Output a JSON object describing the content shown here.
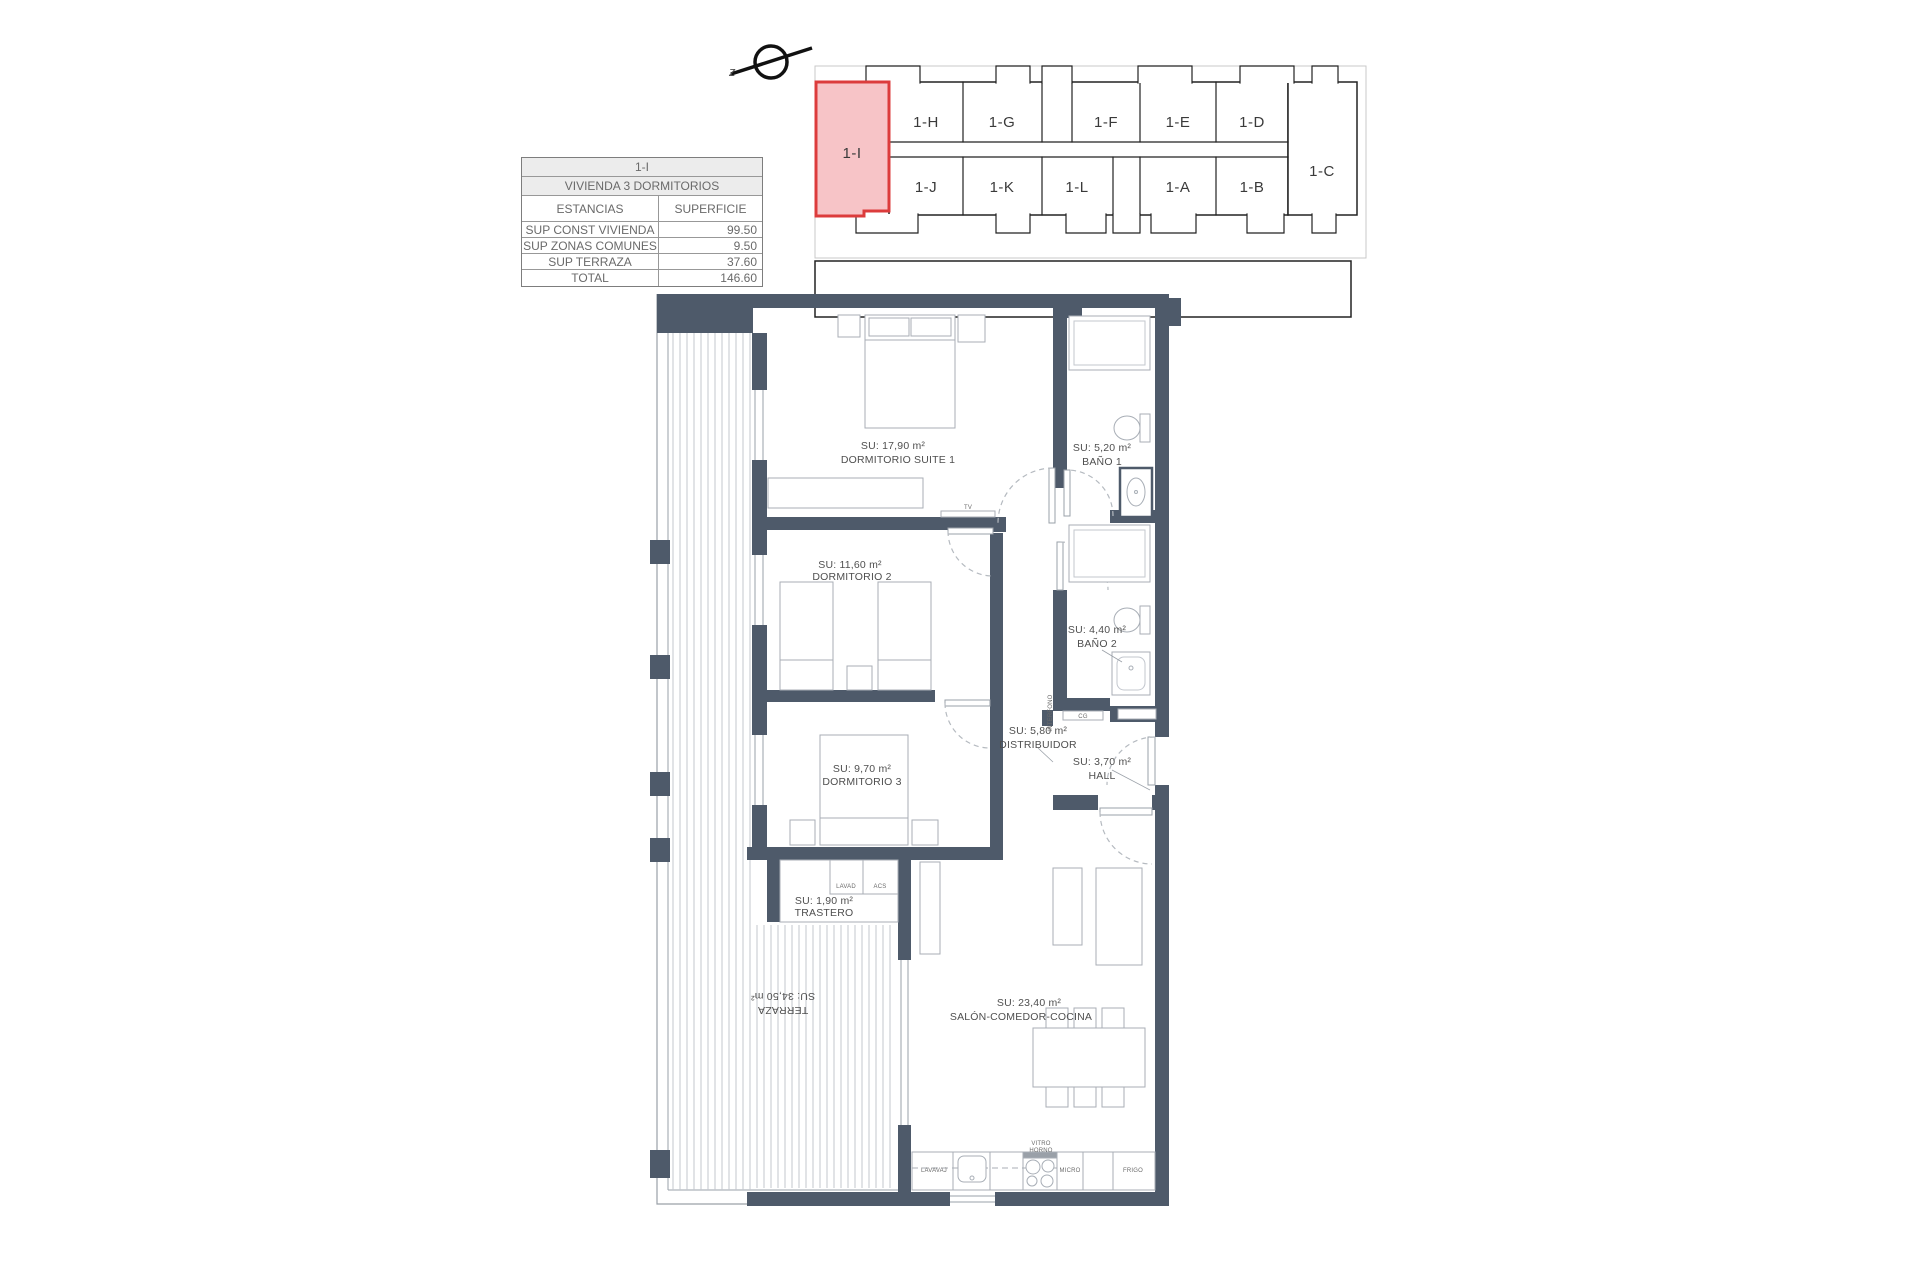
{
  "document": {
    "background": "#ffffff"
  },
  "info_table": {
    "unit": "1-I",
    "title": "VIVIENDA 3 DORMITORIOS",
    "col_estancias": "ESTANCIAS",
    "col_superficie": "SUPERFICIE",
    "rows": [
      {
        "label": "SUP CONST VIVIENDA",
        "value": "99.50"
      },
      {
        "label": "SUP ZONAS COMUNES",
        "value": "9.50"
      },
      {
        "label": "SUP TERRAZA",
        "value": "37.60"
      },
      {
        "label": "TOTAL",
        "value": "146.60"
      }
    ]
  },
  "keyplan": {
    "north_label": "z",
    "highlight_fill": "#f7c4c7",
    "highlight_stroke": "#dc3c3c",
    "units": [
      {
        "id": "1-I",
        "highlighted": true
      },
      {
        "id": "1-H"
      },
      {
        "id": "1-G"
      },
      {
        "id": "1-F"
      },
      {
        "id": "1-E"
      },
      {
        "id": "1-D"
      },
      {
        "id": "1-C"
      },
      {
        "id": "1-J"
      },
      {
        "id": "1-K"
      },
      {
        "id": "1-L"
      },
      {
        "id": "1-A"
      },
      {
        "id": "1-B"
      }
    ]
  },
  "floorplan": {
    "wall_color": "#4e5a6a",
    "rooms": {
      "suite1": {
        "area": "SU: 17,90 m²",
        "name": "DORMITORIO SUITE 1"
      },
      "bano1": {
        "area": "SU: 5,20 m²",
        "name": "BAÑO 1"
      },
      "dorm2": {
        "area": "SU: 11,60 m²",
        "name": "DORMITORIO 2"
      },
      "bano2": {
        "area": "SU: 4,40 m²",
        "name": "BAÑO 2"
      },
      "distribuidor": {
        "area": "SU: 5,80 m²",
        "name": "DISTRIBUIDOR"
      },
      "hall": {
        "area": "SU: 3,70 m²",
        "name": "HALL"
      },
      "dorm3": {
        "area": "SU: 9,70 m²",
        "name": "DORMITORIO 3"
      },
      "trastero": {
        "area": "SU: 1,90 m²",
        "name": "TRASTERO"
      },
      "salon": {
        "area": "SU: 23,40 m²",
        "name": "SALÓN-COMEDOR-COCINA"
      },
      "terraza": {
        "area": "SU: 34,50 m²",
        "name": "TERRAZA"
      }
    },
    "labels": {
      "tv": "TV",
      "lavad": "LAVAD",
      "acs": "ACS",
      "interfono": "INTERFONO",
      "cg": "CG",
      "lavavaj": "LAVAVAJ",
      "vitro": "VITRO",
      "horno": "HORNO",
      "micro": "MICRO",
      "frigo": "FRIGO"
    }
  }
}
